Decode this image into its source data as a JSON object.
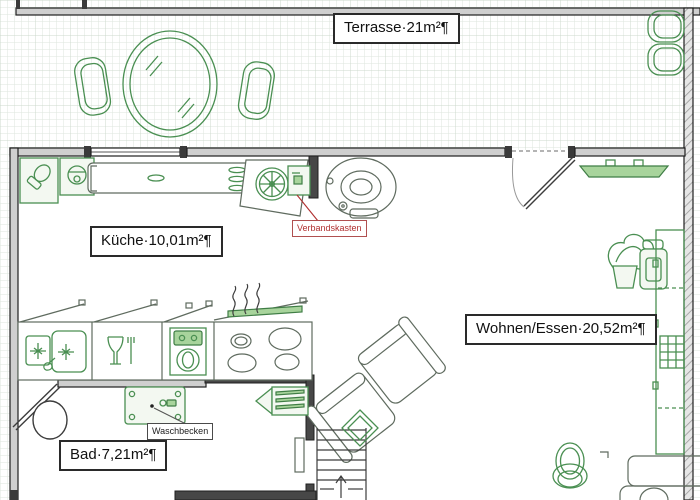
{
  "document": {
    "type": "architectural-floor-plan",
    "style": "word-drawing-with-formatting-marks"
  },
  "rooms": {
    "terrasse": {
      "label": "Terrasse·21m²¶"
    },
    "kueche": {
      "label": "Küche·10,01m²¶"
    },
    "wohnen_essen": {
      "label": "Wohnen/Essen·20,52m²¶"
    },
    "bad": {
      "label": "Bad·7,21m²¶"
    }
  },
  "annotations": {
    "verbandskasten": {
      "label": "Verbandskasten",
      "color": "#b03030"
    },
    "waschbecken": {
      "label": "Waschbecken",
      "color": "#222222"
    }
  },
  "colors": {
    "furniture_green": "#4a8f52",
    "panel_green_fill": "#a8d49c",
    "wall_fill": "#cfcfcf",
    "wall_dark": "#474747",
    "wall_stroke": "#1f1f1f",
    "grid_line": "#dde6dd",
    "annotation_red": "#b03030",
    "neutral_gray": "#5f6b5f"
  },
  "icons": [
    "oval-dining-table-icon",
    "terrace-chair-icon",
    "stacked-chairs-icon",
    "corner-appliance-icon",
    "kitchen-counter-icon",
    "extractor-fan-icon",
    "first-aid-cabinet-icon",
    "round-table-icon",
    "door-swing-icon",
    "window-icon",
    "tv-panel-icon",
    "plant-icon",
    "armchair-icon",
    "sideboard-icon",
    "radiator-grid-icon",
    "sink-icon",
    "dishwasher-icon",
    "oven-icon",
    "stove-burners-icon",
    "steam-icon",
    "sofa-module-icon",
    "stairs-up-icon",
    "washbasin-icon",
    "fin-heater-icon",
    "wc-toilet-icon",
    "low-table-icon"
  ]
}
